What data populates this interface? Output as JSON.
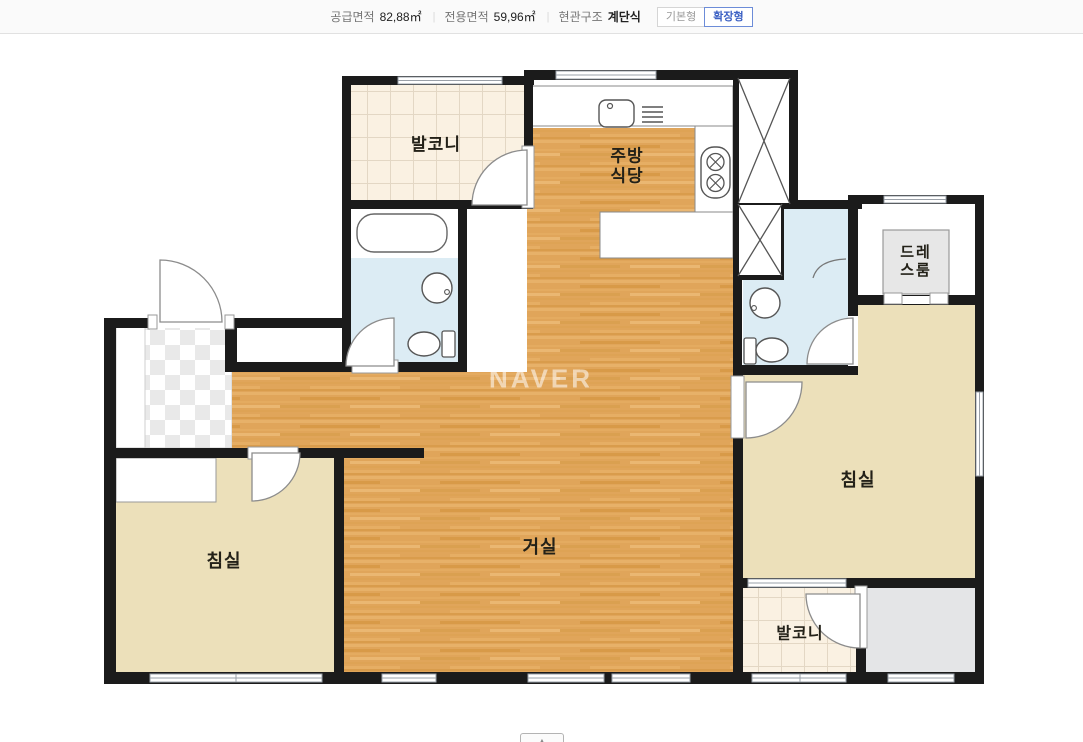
{
  "header": {
    "supply": {
      "label": "공급면적",
      "value": "82,88㎡"
    },
    "exclusive": {
      "label": "전용면적",
      "value": "59,96㎡"
    },
    "entrance": {
      "label": "현관구조",
      "value": "계단식"
    },
    "divider": "|",
    "buttons": {
      "basic": "기본형",
      "extended": "확장형"
    }
  },
  "floorplan": {
    "watermark": "NAVER",
    "labels": {
      "balcony_top": "발코니",
      "kitchen_l1": "주방",
      "kitchen_l2": "식당",
      "dress_l1": "드레",
      "dress_l2": "스룸",
      "living": "거실",
      "bedroom_left": "침실",
      "bedroom_right": "침실",
      "balcony_bottom": "발코니"
    },
    "colors": {
      "wood": "#e0a55a",
      "cream": "#ece0ba",
      "tile": "#faf1e2",
      "bath_blue": "#dcecf4",
      "wall": "#1b1b1b",
      "accent_blue": "#3c61c4"
    }
  },
  "footer": {
    "collapse_icon": "▲"
  }
}
